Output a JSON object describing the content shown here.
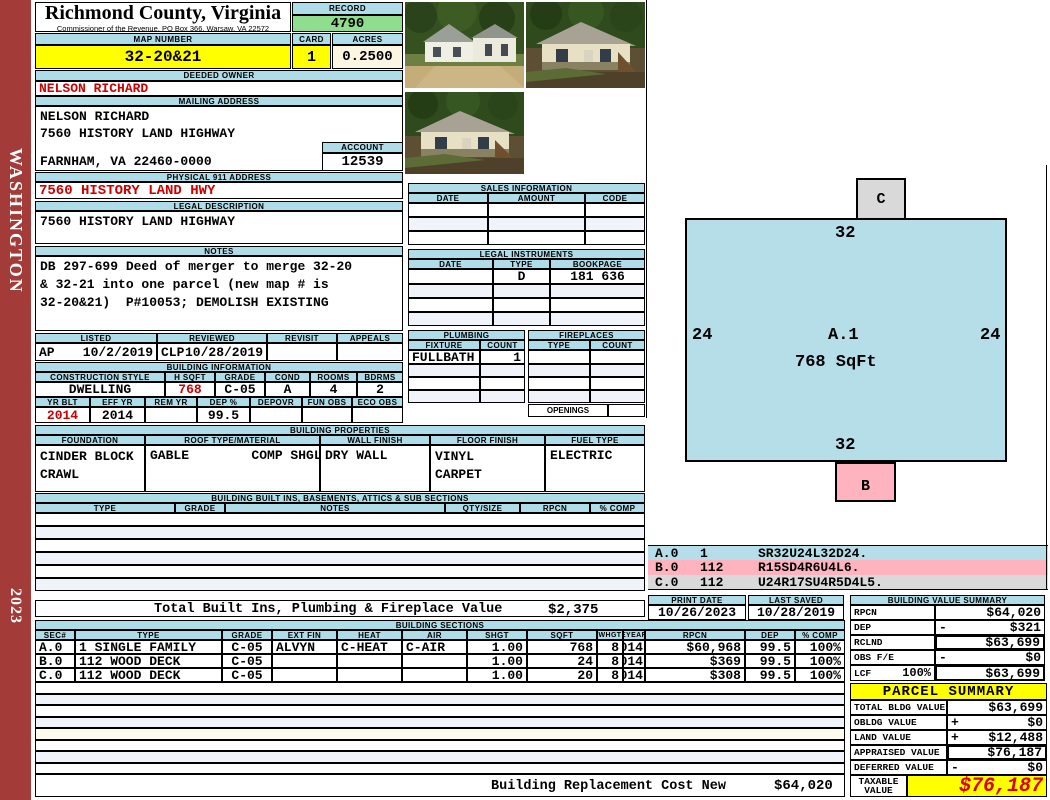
{
  "sidebar": {
    "district": "WASHINGTON",
    "year": "2023"
  },
  "header": {
    "title": "Richmond County, Virginia",
    "subtitle": "Commissioner of the Revenue, PO Box 366, Warsaw, VA 22572",
    "record_label": "RECORD",
    "record": "4790",
    "map_number_label": "MAP NUMBER",
    "map_number": "32-20&21",
    "card_label": "CARD",
    "card": "1",
    "acres_label": "ACRES",
    "acres": "0.2500"
  },
  "owner": {
    "deeded_owner_label": "DEEDED OWNER",
    "deeded_owner": "NELSON RICHARD",
    "mailing_address_label": "MAILING ADDRESS",
    "mailing_line1": "NELSON RICHARD",
    "mailing_line2": "7560 HISTORY LAND HIGHWAY",
    "mailing_line3": "FARNHAM, VA 22460-0000",
    "account_label": "ACCOUNT",
    "account": "12539",
    "physical_911_label": "PHYSICAL 911 ADDRESS",
    "physical_911": "7560 HISTORY LAND HWY",
    "legal_description_label": "LEGAL DESCRIPTION",
    "legal_description": "7560 HISTORY LAND HIGHWAY",
    "notes_label": "NOTES",
    "notes_line1": "DB 297-699 Deed of merger to merge 32-20",
    "notes_line2": "& 32-21 into one parcel (new map # is",
    "notes_line3": "32-20&21)  P#10053; DEMOLISH EXISTING"
  },
  "review": {
    "listed_label": "LISTED",
    "listed_code": "AP",
    "listed_date": "10/2/2019",
    "reviewed_label": "REVIEWED",
    "reviewed_code": "CLP",
    "reviewed_date": "10/28/2019",
    "revisit_label": "REVISIT",
    "appeals_label": "APPEALS"
  },
  "building_info": {
    "section_label": "BUILDING INFORMATION",
    "construction_style_label": "CONSTRUCTION STYLE",
    "construction_style": "DWELLING",
    "hsqft_label": "H SQFT",
    "hsqft": "768",
    "grade_label": "GRADE",
    "grade": "C-05",
    "cond_label": "COND",
    "cond": "A",
    "rooms_label": "ROOMS",
    "rooms": "4",
    "bdrms_label": "BDRMS",
    "bdrms": "2",
    "yr_blt_label": "YR BLT",
    "yr_blt": "2014",
    "eff_yr_label": "EFF YR",
    "eff_yr": "2014",
    "rem_yr_label": "REM YR",
    "dep_pct_label": "DEP %",
    "dep_pct": "99.5",
    "depovr_label": "DEPOVR",
    "fun_obs_label": "FUN OBS",
    "eco_obs_label": "ECO OBS"
  },
  "sales": {
    "section_label": "SALES INFORMATION",
    "date_label": "DATE",
    "amount_label": "AMOUNT",
    "code_label": "CODE"
  },
  "legal_instruments": {
    "section_label": "LEGAL INSTRUMENTS",
    "date_label": "DATE",
    "type_label": "TYPE",
    "bookpage_label": "BOOKPAGE",
    "rows": [
      {
        "date": "",
        "type": "D",
        "bookpage": "181 636"
      }
    ]
  },
  "plumbing": {
    "section_label": "PLUMBING",
    "fixture_label": "FIXTURE",
    "count_label": "COUNT",
    "rows": [
      {
        "fixture": "FULLBATH",
        "count": "1"
      }
    ]
  },
  "fireplaces": {
    "section_label": "FIREPLACES",
    "type_label": "TYPE",
    "count_label": "COUNT",
    "openings_label": "OPENINGS"
  },
  "building_properties": {
    "section_label": "BUILDING PROPERTIES",
    "foundation_label": "FOUNDATION",
    "foundation_line1": "CINDER BLOCK",
    "foundation_line2": "CRAWL",
    "roof_label": "ROOF TYPE/MATERIAL",
    "roof_value": "GABLE        COMP SHGLS",
    "wall_finish_label": "WALL FINISH",
    "wall_finish": "DRY WALL",
    "floor_finish_label": "FLOOR FINISH",
    "floor_finish_line1": "VINYL",
    "floor_finish_line2": "CARPET",
    "fuel_type_label": "FUEL TYPE",
    "fuel_type": "ELECTRIC"
  },
  "built_ins": {
    "section_label": "BUILDING BUILT INS, BASEMENTS, ATTICS & SUB SECTIONS",
    "type_label": "TYPE",
    "grade_label": "GRADE",
    "notes_label": "NOTES",
    "qty_label": "QTY/SIZE",
    "rpcn_label": "RPCN",
    "comp_label": "% COMP",
    "total_label": "Total Built Ins, Plumbing & Fireplace Value",
    "total_value": "$2,375"
  },
  "building_sections": {
    "section_label": "BUILDING SECTIONS",
    "headers": [
      "SEC#",
      "TYPE",
      "GRADE",
      "EXT FIN",
      "HEAT",
      "AIR",
      "SHGT",
      "SQFT",
      "WHGT",
      "EYEAR",
      "RPCN",
      "DEP",
      "% COMP"
    ],
    "rows": [
      {
        "sec": "A.0",
        "type": "1 SINGLE FAMILY",
        "grade": "C-05",
        "ext_fin": "ALVYN",
        "heat": "C-HEAT",
        "air": "C-AIR",
        "shgt": "1.00",
        "sqft": "768",
        "whgt": "8",
        "eyear": "2014",
        "rpcn": "$60,968",
        "dep": "99.5",
        "comp": "100%"
      },
      {
        "sec": "B.0",
        "type": "112 WOOD DECK",
        "grade": "C-05",
        "ext_fin": "",
        "heat": "",
        "air": "",
        "shgt": "1.00",
        "sqft": "24",
        "whgt": "8",
        "eyear": "2014",
        "rpcn": "$369",
        "dep": "99.5",
        "comp": "100%"
      },
      {
        "sec": "C.0",
        "type": "112 WOOD DECK",
        "grade": "C-05",
        "ext_fin": "",
        "heat": "",
        "air": "",
        "shgt": "1.00",
        "sqft": "20",
        "whgt": "8",
        "eyear": "2014",
        "rpcn": "$308",
        "dep": "99.5",
        "comp": "100%"
      }
    ],
    "replacement_label": "Building Replacement Cost New",
    "replacement_value": "$64,020"
  },
  "dates": {
    "print_date_label": "PRINT DATE",
    "print_date": "10/26/2023",
    "last_saved_label": "LAST SAVED",
    "last_saved": "10/28/2019"
  },
  "value_summary": {
    "section_label": "BUILDING VALUE SUMMARY",
    "rows": [
      {
        "label": "RPCN",
        "pct": "",
        "op": "",
        "value": "$64,020"
      },
      {
        "label": "DEP",
        "pct": "",
        "op": "-",
        "value": "$321"
      },
      {
        "label": "RCLND",
        "pct": "",
        "op": "",
        "value": "$63,699"
      },
      {
        "label": "OBS F/E",
        "pct": "",
        "op": "-",
        "value": "$0"
      },
      {
        "label": "LCF",
        "pct": "100%",
        "op": "",
        "value": "$63,699"
      }
    ]
  },
  "parcel_summary": {
    "section_label": "PARCEL SUMMARY",
    "rows": [
      {
        "label": "TOTAL BLDG VALUE",
        "op": "",
        "value": "$63,699"
      },
      {
        "label": "OBLDG VALUE",
        "op": "+",
        "value": "$0"
      },
      {
        "label": "LAND VALUE",
        "op": "+",
        "value": "$12,488"
      },
      {
        "label": "APPRAISED VALUE",
        "op": "",
        "value": "$76,187"
      },
      {
        "label": "DEFERRED VALUE",
        "op": "-",
        "value": "$0"
      }
    ],
    "taxable_label": "TAXABLE VALUE",
    "taxable_value": "$76,187"
  },
  "sketch": {
    "section_id": "A.1",
    "section_sqft": "768 SqFt",
    "dim_top": "32",
    "dim_left": "24",
    "dim_right": "24",
    "dim_bottom": "32",
    "box_b": "B",
    "box_c": "C",
    "legend": [
      {
        "code": "A.0",
        "qty": "1",
        "path": "SR32U24L32D24."
      },
      {
        "code": "B.0",
        "qty": "112",
        "path": "R15SD4R6U4L6."
      },
      {
        "code": "C.0",
        "qty": "112",
        "path": "U24R17SU4R5D4L5."
      }
    ]
  },
  "photos": {
    "count": "3",
    "alt": "exterior photos of dwelling"
  },
  "colors": {
    "accent_blue": "#AEDCE8",
    "highlight_yellow": "#FFFF00",
    "record_green": "#8FDE8F",
    "alert_red": "#CC0000",
    "sidebar_red": "#A33B38",
    "sketch_blue": "#B5DEE9",
    "sketch_pink": "#FFB3BF",
    "sketch_gray": "#D9D9D9"
  }
}
